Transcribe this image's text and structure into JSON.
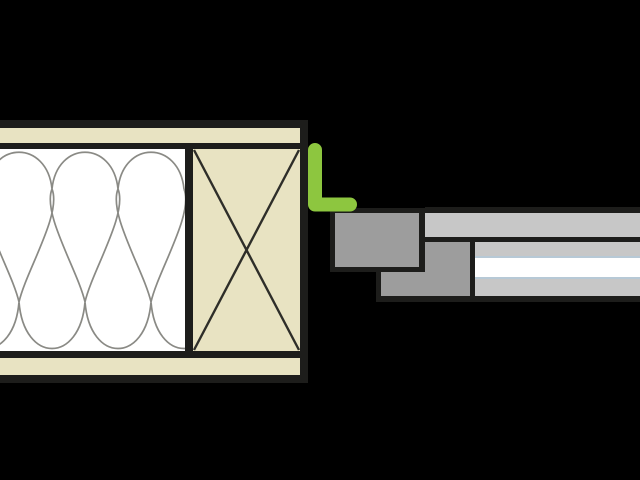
{
  "diagram": {
    "type": "construction-detail-drawing",
    "description": "Horizontal section detail of a window frame connection to a timber-framed wall with batt insulation, wood stud and corner sealing tape",
    "colors": {
      "background": "#000000",
      "outline": "#1d1d1b",
      "wood": "#e8e3c2",
      "white": "#ffffff",
      "insulation_line": "#8a8a85",
      "stud_cross": "#2e2e29",
      "frame_gray": "#9d9d9d",
      "sash_gray": "#c7c7c7",
      "glass_edge_blue": "#b7c9d6",
      "seal_green": "#8dc63f"
    },
    "components": {
      "wall_sheathing_top": "wood board strip (top)",
      "wall_sheathing_bottom": "wood board strip (bottom)",
      "insulation_batt": "mineral wool insulation hatch",
      "timber_stud": "wood cross-section (X symbol)",
      "corner_seal": "green L-shaped sealing tape",
      "frame_block_outer": "window frame profile block",
      "frame_block_inner": "window frame profile block (stepped)",
      "sash_bar": "window sash / casing bar",
      "glazing_unit": "glass pane assembly"
    }
  }
}
